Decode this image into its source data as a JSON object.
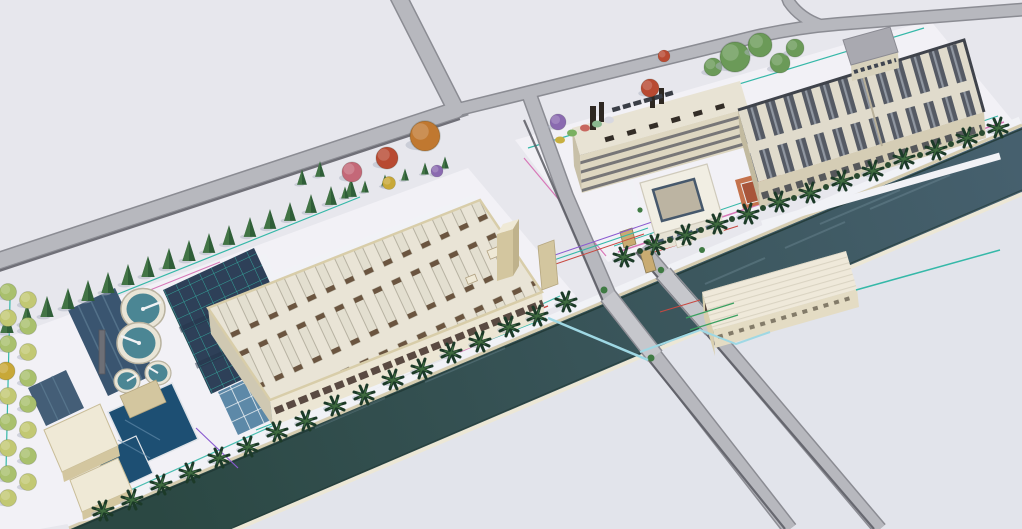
{
  "scene": {
    "view": "aerial-3d-architectural-rendering",
    "waterway": "canal",
    "left_site": {
      "id": "water-treatment-plant",
      "elements": [
        "factory-hall",
        "clarifier-tanks",
        "aeration-basins",
        "filter-basins",
        "storage-pools",
        "pump-houses",
        "stack",
        "conifer-row",
        "autumn-trees",
        "palm-row",
        "tree-columns"
      ],
      "clarifiers_large": 2,
      "clarifiers_small": 2
    },
    "right_site": {
      "id": "industrial-campus",
      "elements": [
        "factory-hall",
        "dormitory-slab",
        "courtyard-office",
        "tennis-court",
        "office-annex",
        "garden",
        "green-tree-cluster",
        "palm-row",
        "parked-cars"
      ]
    },
    "south_bank": {
      "id": "pump-station"
    },
    "roads": [
      "north-approach",
      "west-boulevard",
      "northeast-boulevard",
      "canal-crossing-west",
      "canal-crossing-east"
    ],
    "bridges": 2
  },
  "colors": {
    "ground": "#e7e7ed",
    "ground-low": "#dfe1e9",
    "canal-right": "#46606e",
    "canal-left": "#2b4843",
    "canal-edge": "#1f3733",
    "bank-cream": "#ece7d6",
    "bank-tan": "#d6cdb0",
    "walk": "#f1f2f6",
    "road": "#b7b8be",
    "road-edge": "#8b8c93",
    "road-shadow": "#5a5b63",
    "bridge": "#c6c7cc",
    "rail": "#8e8f96",
    "site": "#f2f1f6",
    "bldg-roof": "#e9e4d6",
    "bldg-roof-edge": "#d8cda9",
    "bldg-face": "#ece6d4",
    "bldg-face-shade": "#cfc8b2",
    "lbar": "#e3dfd0",
    "lbar-cap": "#6b5540",
    "window-dark": "#5a4a42",
    "rfact-roof": "#e0dbcc",
    "rfact-face": "#d5cdb5",
    "rfact-face-shade": "#c2ba9f",
    "rbar": "#555a64",
    "rbar-stripe": "#9aa2ac",
    "rfact-parapet": "#3f434b",
    "dorm-face": "#ded7c1",
    "dorm-roof": "#e8e3d4",
    "dorm-side": "#c8c0a8",
    "band-dark": "#55565e",
    "roof-block": "#332d27",
    "court-roof": "#f1eee3",
    "court-inner": "#bcb4a2",
    "glass": "#46586c",
    "court-face": "#e6e2d4",
    "tennis-out": "#c4724c",
    "tennis-in": "#a8553a",
    "line-white": "#ececec",
    "office-roof": "#a9a9b0",
    "office-face": "#d8d2bc",
    "pump-roof": "#efe9da",
    "pump-face": "#d9cfae",
    "pump-front": "#e4dcc4",
    "ridge": "#d8d2c0",
    "clar-rim": "#e9e5d7",
    "clar-wall": "#c9c2ab",
    "clar-water": "#4b8694",
    "clar-bridge": "#f0f2f4",
    "aer-base": "#2e4058",
    "filter-base": "#5d89a8",
    "pool": "#1d4f73",
    "pool-edge": "#dfe3e8",
    "basin-dark": "#3a5570",
    "basin-streak": "#5e7d94",
    "tank-bldg": "#d3c69f",
    "tank-roof": "#efe9d6",
    "conifer-dark": "#2f5e38",
    "conifer-light": "#558a52",
    "palm-dark": "#1c3a28",
    "palm-light": "#3f6b3f",
    "shrub": "#3f7a43",
    "hedge": "#2a4a30",
    "tree-lightgreen": "#a9c06d",
    "tree-yellowgreen": "#c2c873",
    "tree-yellow": "#c8a838",
    "tree-orange": "#c07830",
    "tree-red": "#b84a32",
    "tree-pink": "#c46878",
    "tree-purple": "#8a6ab0",
    "tree-green": "#6b9a58",
    "line-teal": "#35b8a8",
    "line-pink": "#d878b8",
    "line-red": "#c84840",
    "line-green": "#3aa060",
    "line-purple": "#8a5ad0",
    "pipe-cyan": "#9fd8e4",
    "shadow": "#aeb3c2",
    "stack": "#6d6f76",
    "stack-dark": "#2e2822",
    "gate-tan": "#c9ab72"
  }
}
